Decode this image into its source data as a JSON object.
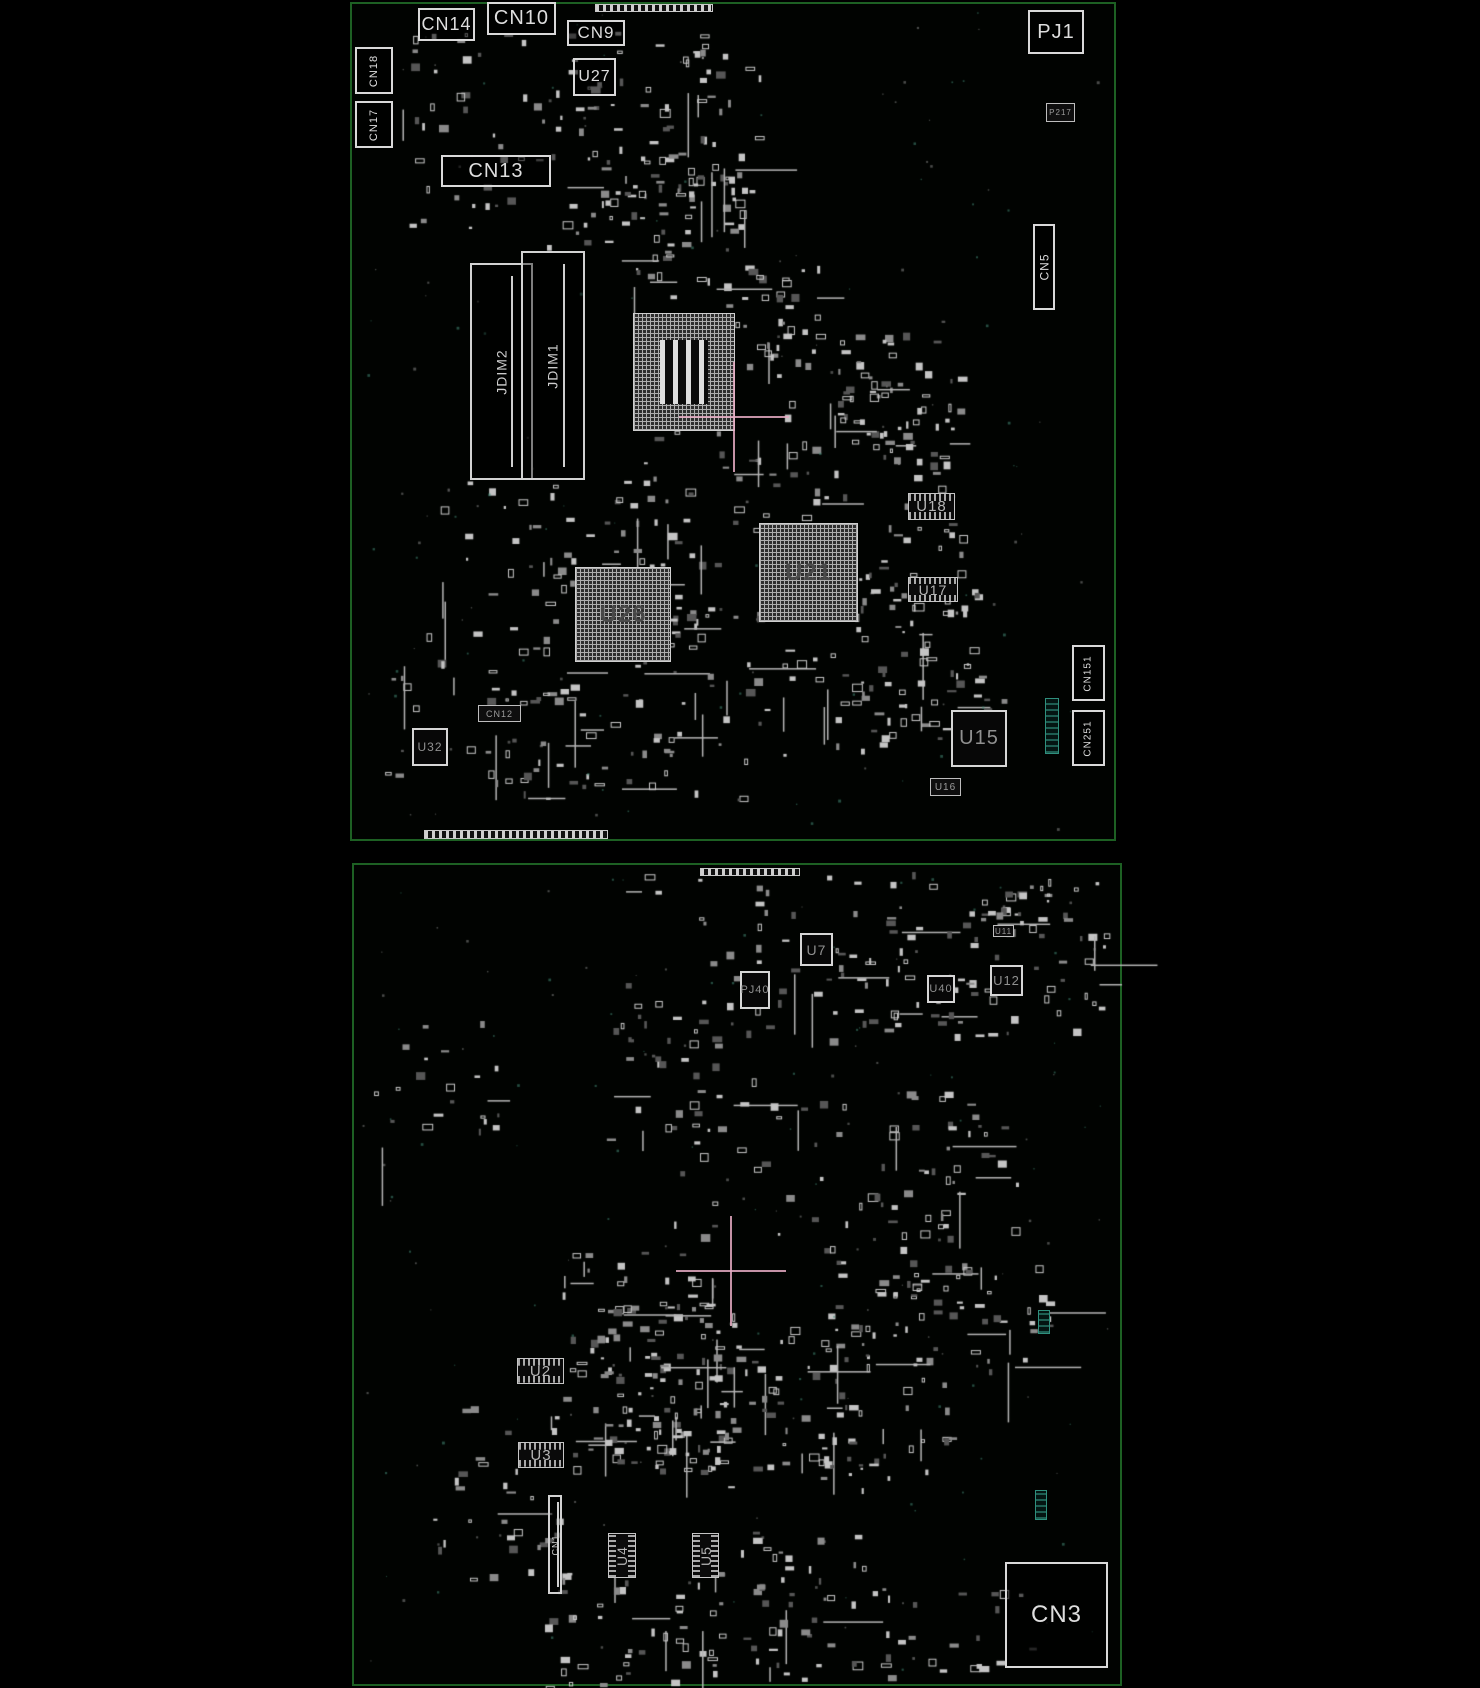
{
  "colors": {
    "background": "#000000",
    "board_outline_green": "#1d6023",
    "component_outline": "#d9d9d9",
    "component_label_gray": "#909090",
    "teal_accent": "#2f8f7d",
    "crosshair_pink": "#e6acc3"
  },
  "boards": [
    {
      "name": "top-board-view",
      "outline": {
        "x": 350,
        "y": 2,
        "w": 766,
        "h": 839
      },
      "components": [
        {
          "label": "CN14",
          "type": "label-box",
          "x": 418,
          "y": 8,
          "w": 57,
          "h": 33,
          "fs": 18
        },
        {
          "label": "CN10",
          "type": "label-box",
          "x": 487,
          "y": 2,
          "w": 69,
          "h": 33,
          "fs": 20
        },
        {
          "label": "CN9",
          "type": "label-box",
          "x": 567,
          "y": 20,
          "w": 58,
          "h": 26,
          "fs": 17
        },
        {
          "label": "U27",
          "type": "label-box",
          "x": 573,
          "y": 58,
          "w": 43,
          "h": 38,
          "fs": 16
        },
        {
          "label": "CN18",
          "type": "label-box",
          "x": 355,
          "y": 47,
          "w": 38,
          "h": 47,
          "fs": 11,
          "rot": true
        },
        {
          "label": "CN17",
          "type": "label-box",
          "x": 355,
          "y": 101,
          "w": 38,
          "h": 47,
          "fs": 11,
          "rot": true
        },
        {
          "label": "CN13",
          "type": "label-box",
          "x": 441,
          "y": 155,
          "w": 110,
          "h": 32,
          "fs": 20
        },
        {
          "label": "PJ1",
          "type": "label-box",
          "x": 1028,
          "y": 10,
          "w": 56,
          "h": 44,
          "fs": 20
        },
        {
          "label": "P217",
          "type": "dark",
          "x": 1046,
          "y": 103,
          "w": 29,
          "h": 19,
          "fs": 8
        },
        {
          "label": "CN5",
          "type": "label-box",
          "x": 1033,
          "y": 224,
          "w": 22,
          "h": 86,
          "fs": 12,
          "rot": true
        },
        {
          "label": "JDIM2",
          "type": "slot",
          "x": 470,
          "y": 263,
          "w": 63,
          "h": 217,
          "fs": 14,
          "rot": true
        },
        {
          "label": "JDIM1",
          "type": "slot",
          "x": 521,
          "y": 251,
          "w": 64,
          "h": 229,
          "fs": 14,
          "rot": true
        },
        {
          "label": "",
          "type": "bga-cpu",
          "x": 633,
          "y": 313,
          "w": 102,
          "h": 118
        },
        {
          "label": "U26",
          "type": "bga",
          "x": 575,
          "y": 567,
          "w": 96,
          "h": 95,
          "fs": 24
        },
        {
          "label": "U21",
          "type": "bga",
          "x": 759,
          "y": 523,
          "w": 99,
          "h": 99,
          "fs": 24
        },
        {
          "label": "U18",
          "type": "hatch",
          "x": 908,
          "y": 493,
          "w": 47,
          "h": 27,
          "fs": 15
        },
        {
          "label": "U17",
          "type": "hatch",
          "x": 908,
          "y": 577,
          "w": 50,
          "h": 25,
          "fs": 14
        },
        {
          "label": "U15",
          "type": "chip",
          "x": 951,
          "y": 710,
          "w": 56,
          "h": 57,
          "fs": 20
        },
        {
          "label": "U16",
          "type": "dark",
          "x": 930,
          "y": 778,
          "w": 31,
          "h": 18,
          "fs": 10
        },
        {
          "label": "U32",
          "type": "chip",
          "x": 412,
          "y": 728,
          "w": 36,
          "h": 38,
          "fs": 12
        },
        {
          "label": "CN12",
          "type": "dark",
          "x": 478,
          "y": 705,
          "w": 43,
          "h": 17,
          "fs": 9
        },
        {
          "label": "CN151",
          "type": "label-box",
          "x": 1072,
          "y": 645,
          "w": 33,
          "h": 56,
          "fs": 10,
          "rot": true
        },
        {
          "label": "CN251",
          "type": "label-box",
          "x": 1072,
          "y": 710,
          "w": 33,
          "h": 56,
          "fs": 10,
          "rot": true
        },
        {
          "label": "",
          "type": "edge",
          "x": 424,
          "y": 830,
          "w": 184,
          "h": 9
        },
        {
          "label": "",
          "type": "edge",
          "x": 595,
          "y": 4,
          "w": 118,
          "h": 8
        },
        {
          "label": "",
          "type": "teal",
          "x": 1045,
          "y": 698,
          "w": 14,
          "h": 56
        }
      ],
      "crosshairs": [
        {
          "x": 734,
          "y": 417
        }
      ],
      "noise_clusters": [
        [
          395,
          25,
          330,
          220,
          90
        ],
        [
          560,
          40,
          200,
          200,
          55
        ],
        [
          620,
          150,
          140,
          150,
          40
        ],
        [
          700,
          250,
          120,
          110,
          25
        ],
        [
          745,
          320,
          210,
          160,
          55
        ],
        [
          830,
          330,
          130,
          120,
          35
        ],
        [
          440,
          480,
          250,
          170,
          65
        ],
        [
          610,
          430,
          210,
          200,
          60
        ],
        [
          630,
          610,
          250,
          150,
          55
        ],
        [
          820,
          430,
          150,
          190,
          45
        ],
        [
          855,
          555,
          130,
          190,
          40
        ],
        [
          375,
          630,
          220,
          150,
          40
        ],
        [
          480,
          670,
          260,
          130,
          45
        ],
        [
          895,
          620,
          110,
          110,
          22
        ],
        [
          360,
          10,
          740,
          820,
          130
        ]
      ]
    },
    {
      "name": "bottom-board-view",
      "outline": {
        "x": 352,
        "y": 863,
        "w": 770,
        "h": 823
      },
      "components": [
        {
          "label": "U7",
          "type": "chip",
          "x": 800,
          "y": 933,
          "w": 33,
          "h": 33,
          "fs": 14
        },
        {
          "label": "PJ40",
          "type": "chip",
          "x": 740,
          "y": 971,
          "w": 30,
          "h": 38,
          "fs": 11
        },
        {
          "label": "U40",
          "type": "chip",
          "x": 927,
          "y": 975,
          "w": 28,
          "h": 28,
          "fs": 11
        },
        {
          "label": "U12",
          "type": "chip",
          "x": 990,
          "y": 965,
          "w": 33,
          "h": 31,
          "fs": 13
        },
        {
          "label": "U11",
          "type": "dark",
          "x": 993,
          "y": 925,
          "w": 21,
          "h": 12,
          "fs": 8
        },
        {
          "label": "U2",
          "type": "hatch",
          "x": 517,
          "y": 1358,
          "w": 47,
          "h": 26,
          "fs": 15
        },
        {
          "label": "U3",
          "type": "hatch",
          "x": 518,
          "y": 1442,
          "w": 46,
          "h": 26,
          "fs": 15
        },
        {
          "label": "U4",
          "type": "hatch",
          "x": 608,
          "y": 1533,
          "w": 28,
          "h": 45,
          "fs": 14,
          "rot": true
        },
        {
          "label": "U5",
          "type": "hatch",
          "x": 692,
          "y": 1533,
          "w": 27,
          "h": 45,
          "fs": 14,
          "rot": true
        },
        {
          "label": "CN1",
          "type": "slot",
          "x": 548,
          "y": 1495,
          "w": 14,
          "h": 99,
          "fs": 9,
          "rot": true
        },
        {
          "label": "CN3",
          "type": "label-box",
          "x": 1005,
          "y": 1562,
          "w": 103,
          "h": 106,
          "fs": 24
        },
        {
          "label": "",
          "type": "teal",
          "x": 1035,
          "y": 1490,
          "w": 12,
          "h": 30
        },
        {
          "label": "",
          "type": "teal",
          "x": 1038,
          "y": 1310,
          "w": 12,
          "h": 24
        },
        {
          "label": "",
          "type": "edge",
          "x": 700,
          "y": 868,
          "w": 100,
          "h": 8
        }
      ],
      "crosshairs": [
        {
          "x": 731,
          "y": 1271
        }
      ],
      "noise_clusters": [
        [
          620,
          870,
          440,
          170,
          110
        ],
        [
          890,
          880,
          215,
          150,
          55
        ],
        [
          370,
          1020,
          130,
          130,
          22
        ],
        [
          600,
          1020,
          170,
          130,
          28
        ],
        [
          670,
          1090,
          300,
          150,
          45
        ],
        [
          850,
          1090,
          180,
          280,
          50
        ],
        [
          550,
          1250,
          180,
          220,
          90
        ],
        [
          590,
          1300,
          150,
          170,
          70
        ],
        [
          710,
          1320,
          180,
          170,
          70
        ],
        [
          820,
          1240,
          130,
          230,
          45
        ],
        [
          910,
          1260,
          140,
          140,
          28
        ],
        [
          430,
          1400,
          140,
          180,
          32
        ],
        [
          540,
          1550,
          280,
          140,
          65
        ],
        [
          750,
          1530,
          140,
          140,
          35
        ],
        [
          880,
          1590,
          150,
          90,
          22
        ],
        [
          360,
          870,
          750,
          800,
          150
        ]
      ]
    }
  ]
}
